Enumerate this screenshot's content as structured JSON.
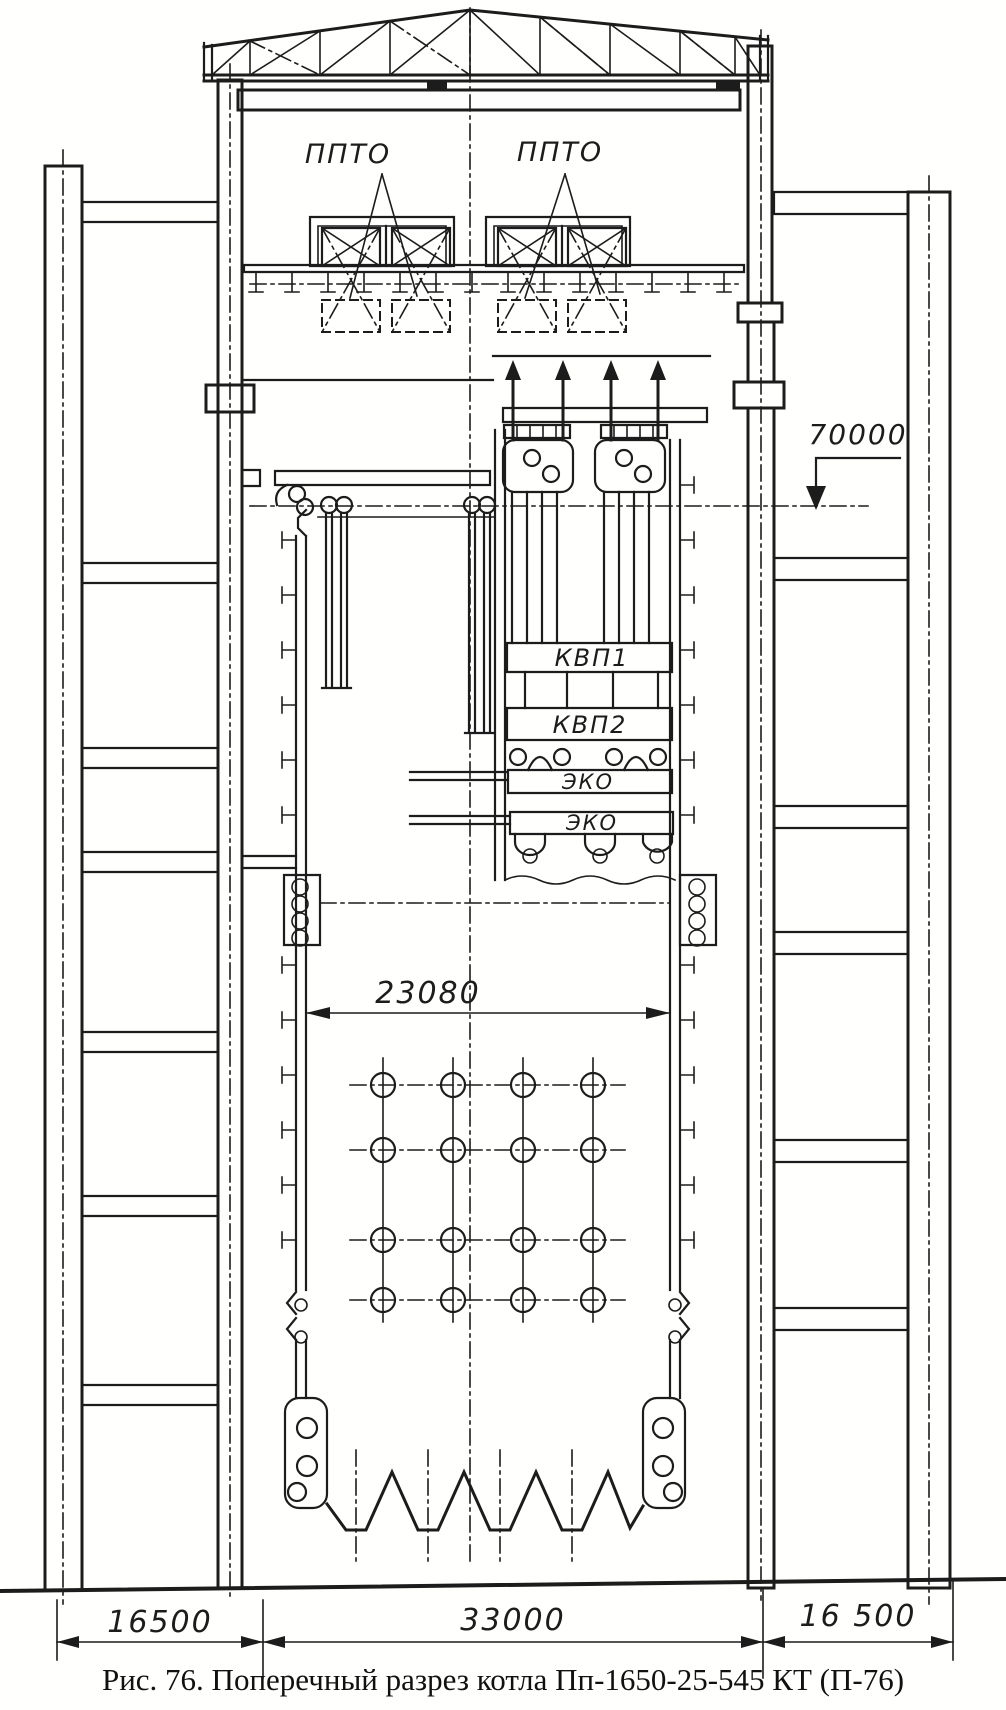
{
  "labels": {
    "ppto_left": "ППТО",
    "ppto_right": "ППТО",
    "kvp1": "КВП1",
    "kvp2": "КВП2",
    "eko_upper": "ЭКО",
    "eko_lower": "ЭКО"
  },
  "dimensions": {
    "elevation_top": "70000",
    "furnace_width": "23080",
    "span_left": "16500",
    "span_center": "33000",
    "span_right": "16 500"
  },
  "caption": "Рис. 76. Поперечный разрез котла Пп-1650-25-545 КТ (П-76)",
  "colors": {
    "ink": "#1c1c1c",
    "paper": "#ffffff"
  }
}
